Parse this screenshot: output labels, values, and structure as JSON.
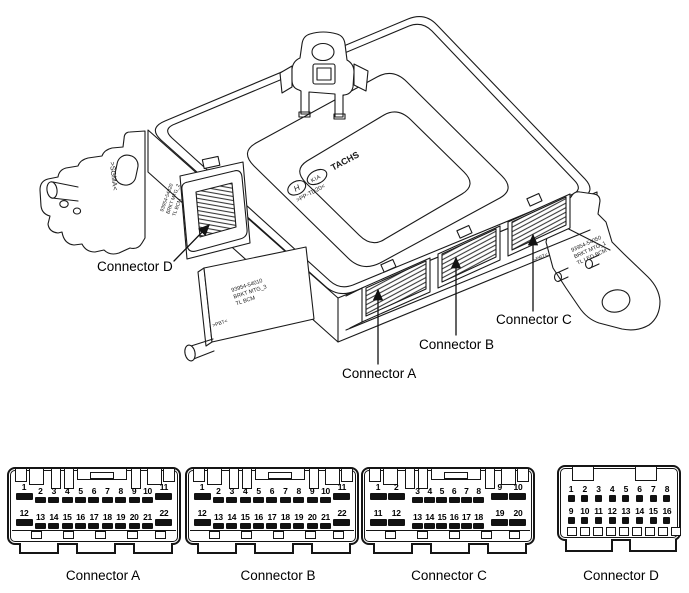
{
  "callouts": {
    "connector_a": "Connector A",
    "connector_b": "Connector B",
    "connector_c": "Connector C",
    "connector_d": "Connector D"
  },
  "markings": {
    "hyundai_logo": "H",
    "kia_logo": "KIA",
    "tachs_logo": "TACHS",
    "top_material": ">PP-TD20<",
    "left_bracket_material": ">SGMA<",
    "side_label": [
      "93954-54020",
      "BRKT MTG_2",
      "TL BCM"
    ],
    "bottom_bracket_label": [
      "93954-54010",
      "BRKT MTG_3",
      "TL BCM"
    ],
    "bottom_bracket_material": ">PBT<",
    "right_bracket_label": [
      "93954-54050",
      "BRKT MTG_1",
      "TL LED BCM"
    ],
    "right_bracket_material": ">PBT<"
  },
  "connectors": [
    {
      "id": "a",
      "label": "Connector A",
      "style": "abc",
      "rows": [
        [
          "1L",
          "2",
          "3",
          "4",
          "5",
          "6",
          "7",
          "8",
          "9",
          "10",
          "11L"
        ],
        [
          "12L",
          "13",
          "14",
          "15",
          "16",
          "17",
          "18",
          "19",
          "20",
          "21",
          "22L"
        ]
      ]
    },
    {
      "id": "b",
      "label": "Connector B",
      "style": "abc",
      "rows": [
        [
          "1L",
          "2",
          "3",
          "4",
          "5",
          "6",
          "7",
          "8",
          "9",
          "10",
          "11L"
        ],
        [
          "12L",
          "13",
          "14",
          "15",
          "16",
          "17",
          "18",
          "19",
          "20",
          "21",
          "22L"
        ]
      ]
    },
    {
      "id": "c",
      "label": "Connector C",
      "style": "abc",
      "rows": [
        [
          "1L",
          "2L",
          "3",
          "4",
          "5",
          "6",
          "7",
          "8",
          "9L",
          "10L"
        ],
        [
          "11L",
          "12L",
          "13",
          "14",
          "15",
          "16",
          "17",
          "18",
          "19L",
          "20L"
        ]
      ]
    },
    {
      "id": "d",
      "label": "Connector D",
      "style": "d",
      "rows": [
        [
          "1",
          "2",
          "3",
          "4",
          "5",
          "6",
          "7",
          "8"
        ],
        [
          "9",
          "10",
          "11",
          "12",
          "13",
          "14",
          "15",
          "16"
        ]
      ]
    }
  ]
}
